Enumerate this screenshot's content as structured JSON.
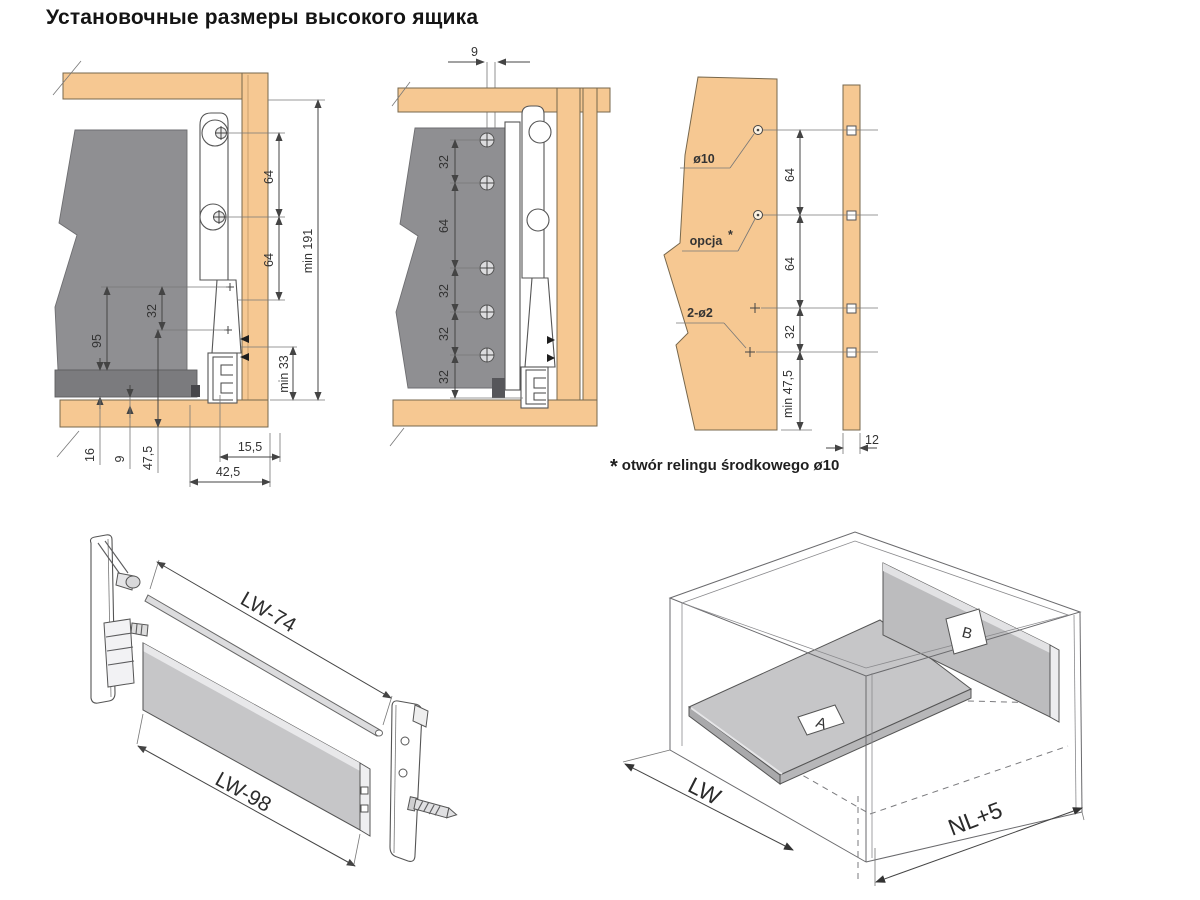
{
  "title": "Установочные размеры высокого ящика",
  "colors": {
    "wood": "#f6c892",
    "panel_gray": "#8f8f92",
    "slab_gray": "#c6c6c8",
    "line": "#444444",
    "background": "#ffffff"
  },
  "front_section": {
    "dim_64_top": "64",
    "dim_64_mid": "64",
    "dim_min191": "min 191",
    "dim_min33": "min 33",
    "dim_95": "95",
    "dim_32": "32",
    "dim_16": "16",
    "dim_9": "9",
    "dim_47_5": "47,5",
    "dim_42_5": "42,5",
    "dim_15_5": "15,5"
  },
  "back_section": {
    "dim_9": "9",
    "dim_32_1": "32",
    "dim_64": "64",
    "dim_32_2": "32",
    "dim_32_3": "32",
    "dim_32_4": "32"
  },
  "drill_panel": {
    "label_d10": "ø10",
    "label_opcja": "opcja",
    "label_opcja_star": "*",
    "label_2d2": "2-ø2",
    "dim_64_1": "64",
    "dim_64_2": "64",
    "dim_32": "32",
    "dim_min475": "min 47,5",
    "dim_12": "12"
  },
  "footnote": {
    "star": "*",
    "text": "otwór relingu środkowego ø10"
  },
  "exploded": {
    "dim_rail": "LW-74",
    "dim_panel": "LW-98"
  },
  "assembly": {
    "dim_width": "LW",
    "dim_depth": "NL+5",
    "tag_a": "A",
    "tag_b": "B"
  }
}
